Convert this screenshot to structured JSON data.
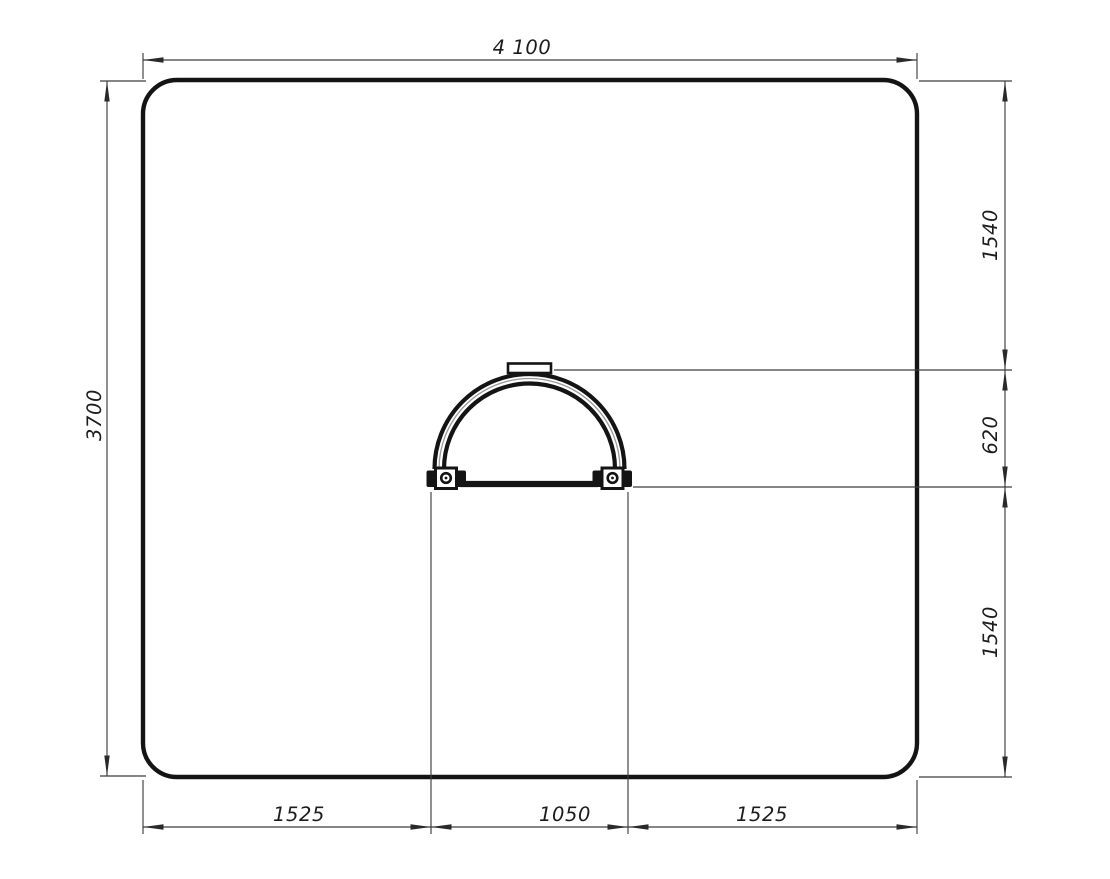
{
  "drawing": {
    "kind": "technical-drawing-top-view",
    "background": "#ffffff",
    "colors": {
      "outline": "#141414",
      "dimension_lines": "#3d3d3d",
      "dimension_text": "#1c1c1c"
    },
    "dimensions": {
      "top_width": "4 100",
      "left_height": "3700",
      "right_upper": "1540",
      "right_middle": "620",
      "right_lower": "1540",
      "bottom_left": "1525",
      "bottom_center": "1050",
      "bottom_right": "1525"
    }
  }
}
